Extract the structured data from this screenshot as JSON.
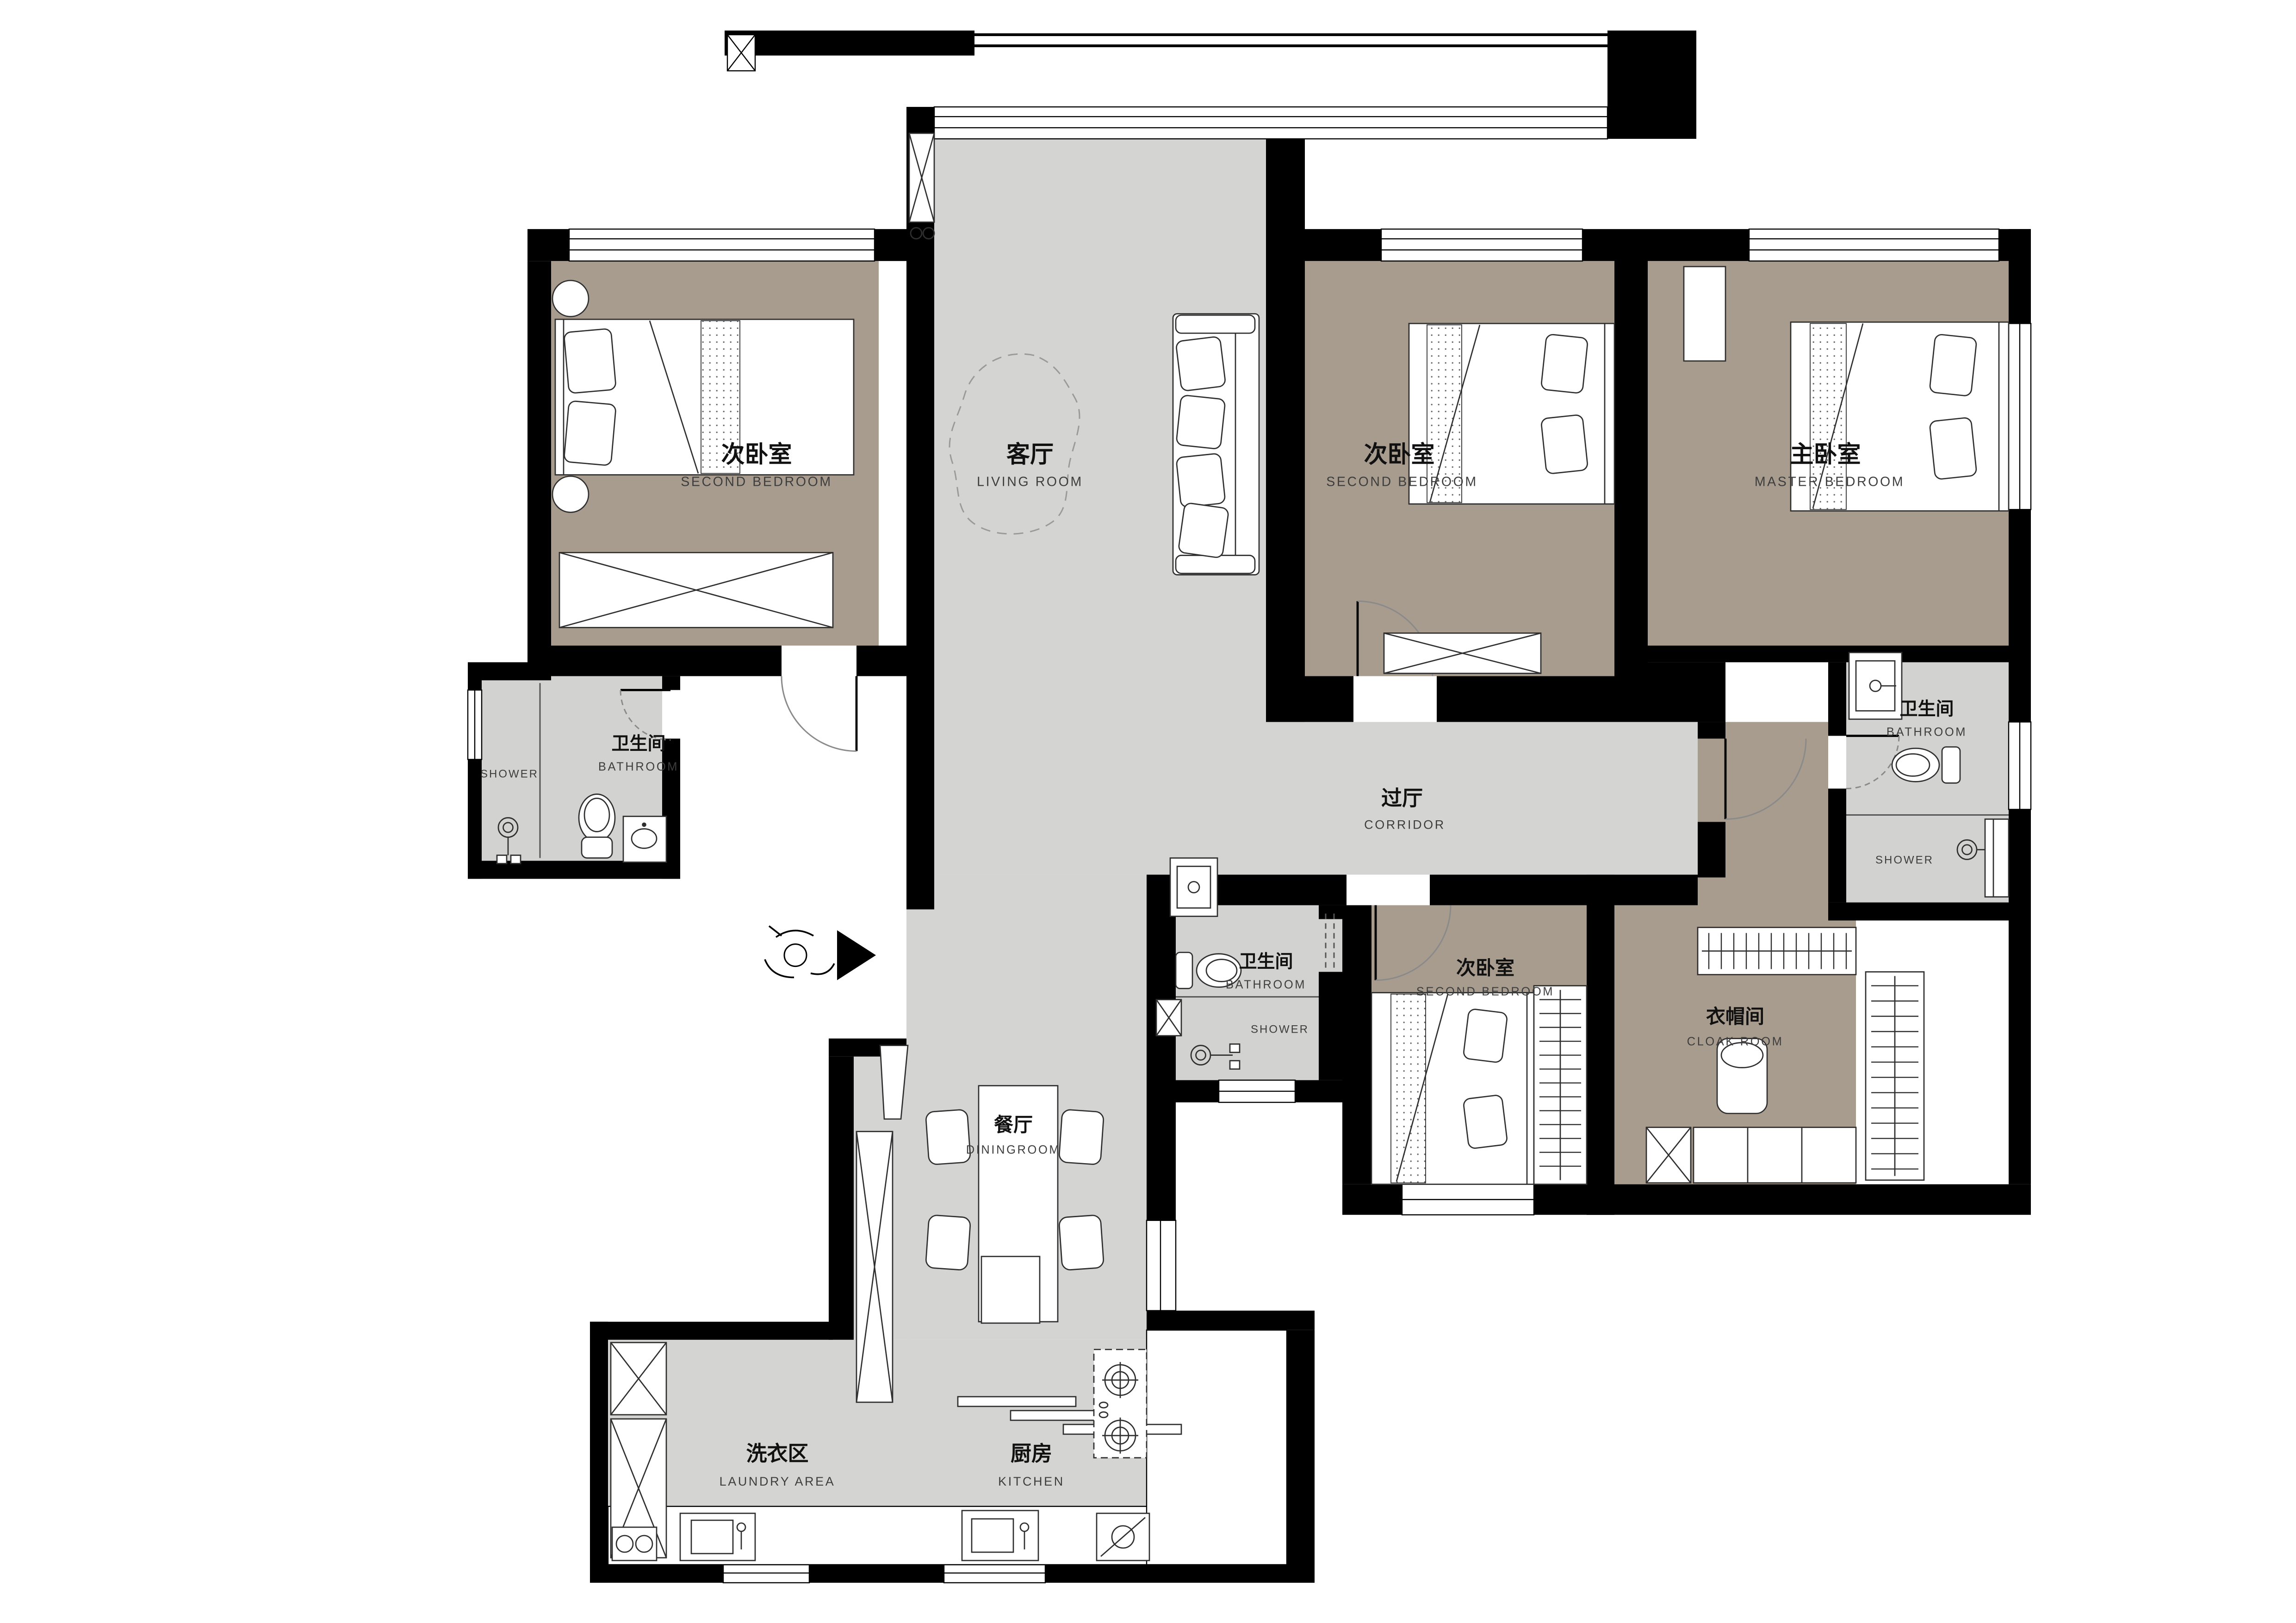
{
  "drawing": {
    "type": "apartment-floor-plan",
    "colors": {
      "wall": "#000000",
      "public_floor": "#d4d4d3",
      "bedroom_floor": "#a89c8e",
      "bathroom_floor": "#d2d2d1",
      "furniture_fill": "#ffffff",
      "line": "#2f2f2f"
    }
  },
  "rooms": [
    {
      "id": "second-bedroom-left",
      "name_cn": "次卧室",
      "name_en": "SECOND BEDROOM"
    },
    {
      "id": "living-room",
      "name_cn": "客厅",
      "name_en": "LIVING ROOM"
    },
    {
      "id": "second-bedroom-top",
      "name_cn": "次卧室",
      "name_en": "SECOND BEDROOM"
    },
    {
      "id": "master-bedroom",
      "name_cn": "主卧室",
      "name_en": "MASTER BEDROOM"
    },
    {
      "id": "bathroom-left",
      "name_cn": "卫生间",
      "name_en": "BATHROOM",
      "zone": "SHOWER"
    },
    {
      "id": "corridor",
      "name_cn": "过厅",
      "name_en": "CORRIDOR"
    },
    {
      "id": "bathroom-right",
      "name_cn": "卫生间",
      "name_en": "BATHROOM",
      "zone": "SHOWER"
    },
    {
      "id": "second-bedroom-bottom",
      "name_cn": "次卧室",
      "name_en": "SECOND BEDROOM"
    },
    {
      "id": "cloak-room",
      "name_cn": "衣帽间",
      "name_en": "CLOAK ROOM"
    },
    {
      "id": "bathroom-center",
      "name_cn": "卫生间",
      "name_en": "BATHROOM",
      "zone": "SHOWER"
    },
    {
      "id": "dining-room",
      "name_cn": "餐厅",
      "name_en": "DININGROOM"
    },
    {
      "id": "laundry-area",
      "name_cn": "洗衣区",
      "name_en": "LAUNDRY AREA"
    },
    {
      "id": "kitchen",
      "name_cn": "厨房",
      "name_en": "KITCHEN"
    }
  ]
}
